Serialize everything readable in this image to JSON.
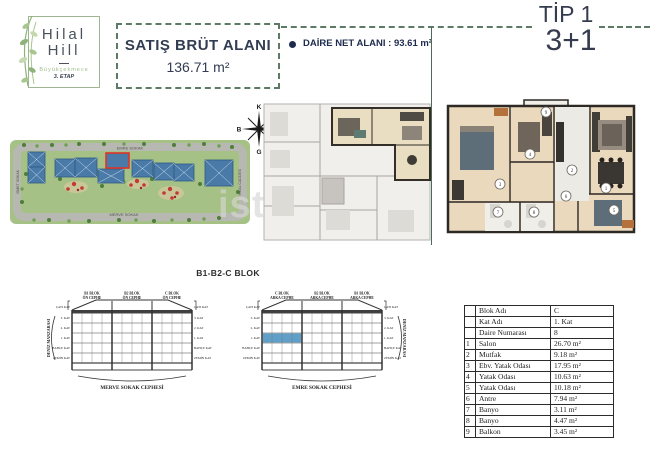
{
  "header": {
    "logo": {
      "name1": "Hilal",
      "name2": "Hill",
      "location": "Büyükçekmece",
      "etap": "3. ETAP"
    },
    "gross_area_label": "SATIŞ BRÜT ALANI",
    "gross_area_value": "136.71 m²",
    "net_area_label": "DAİRE NET ALANI : 93.61 m²",
    "type_label": "TİP 1",
    "layout_label": "3+1"
  },
  "site_plan": {
    "roads": {
      "top": "EMRE SOKAK",
      "bottom": "MERVE SOKAK",
      "left": "İSMET SOKAK",
      "right": "HİLAL CADDESİ"
    }
  },
  "compass": {
    "north": "K",
    "east": "D",
    "south": "G",
    "west": "B"
  },
  "watermark": "ist",
  "block_section": {
    "title": "B1-B2-C BLOK",
    "sea_view_label": "DENİZ MANZARASI",
    "roof_label": "ÇATI KAT",
    "floors": [
      "3. KAT",
      "2. KAT",
      "1. KAT",
      "BAHÇE KAT",
      "ZEMİN KAT"
    ],
    "elevations": [
      {
        "caption": "MERVE SOKAK CEPHESİ",
        "columns": [
          {
            "l1": "B1 BLOK",
            "l2": "ÖN CEPHE"
          },
          {
            "l1": "B2 BLOK",
            "l2": "ÖN CEPHE"
          },
          {
            "l1": "C BLOK",
            "l2": "ÖN CEPHE"
          }
        ]
      },
      {
        "caption": "EMRE SOKAK CEPHESİ",
        "columns": [
          {
            "l1": "C BLOK",
            "l2": "ARKA CEPHE"
          },
          {
            "l1": "B2 BLOK",
            "l2": "ARKA CEPHE"
          },
          {
            "l1": "B1 BLOK",
            "l2": "ARKA CEPHE"
          }
        ]
      }
    ]
  },
  "apartment_table": {
    "info": [
      {
        "label": "Blok Adı",
        "value": "C"
      },
      {
        "label": "Kat Adı",
        "value": "1. Kat"
      },
      {
        "label": "Daire Numarası",
        "value": "8"
      }
    ],
    "rooms": [
      {
        "no": "1",
        "name": "Salon",
        "area": "26.70 m²"
      },
      {
        "no": "2",
        "name": "Mutfak",
        "area": "9.18 m²"
      },
      {
        "no": "3",
        "name": "Ebv. Yatak Odası",
        "area": "17.95 m²"
      },
      {
        "no": "4",
        "name": "Yatak Odası",
        "area": "10.63 m²"
      },
      {
        "no": "5",
        "name": "Yatak Odası",
        "area": "10.18 m²"
      },
      {
        "no": "6",
        "name": "Antre",
        "area": "7.94 m²"
      },
      {
        "no": "7",
        "name": "Banyo",
        "area": "3.11 m²"
      },
      {
        "no": "8",
        "name": "Banyo",
        "area": "4.47 m²"
      },
      {
        "no": "9",
        "name": "Balkon",
        "area": "3.45 m²"
      }
    ]
  },
  "colors": {
    "accent_green": "#5c7a66",
    "navy": "#1e2b4f",
    "grass_green": "#a5c186",
    "building_blue": "#4a7aa8",
    "highlight_red": "#e03328",
    "cell_blue": "#5f9fc8",
    "plan_beige": "#ead9bc"
  }
}
